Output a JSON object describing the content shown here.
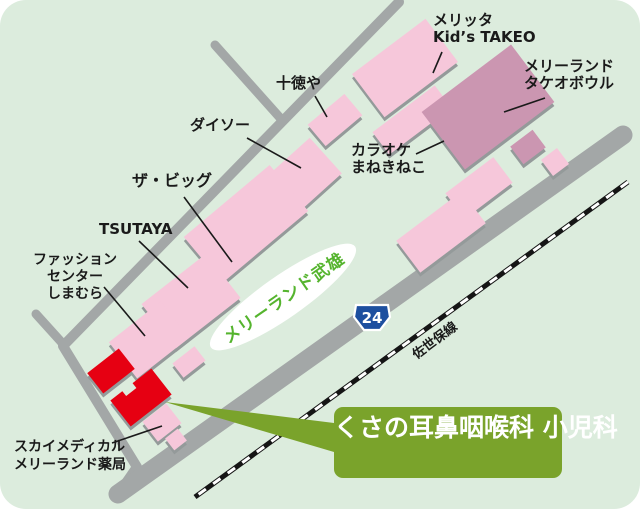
{
  "map_title": "くさの耳鼻咽喉科 小児科 案内地図",
  "colors": {
    "map_bg": "#dcecdd",
    "building_pink": "#f6c7da",
    "building_mauve": "#cb96b1",
    "building_red": "#e60012",
    "road_gray": "#a3a7a7",
    "shadow_gray": "#949a9a",
    "callout_green": "#7aa32b",
    "ellipse_text_green": "#55b42e",
    "shield_blue": "#1d4f9f",
    "railway_black": "#151515",
    "label_black": "#1a1a1a"
  },
  "labels": {
    "melitta": {
      "line1": "メリッタ",
      "line2": "Kid’s TAKEO"
    },
    "bowl": {
      "line1": "メリーランド",
      "line2": "タケオボウル"
    },
    "karaoke": {
      "line1": "カラオケ",
      "line2": "まねきねこ"
    },
    "jutokuya": "十徳や",
    "daiso": "ダイソー",
    "big": "ザ・ビッグ",
    "tsutaya": "TSUTAYA",
    "fashion": {
      "line1": "ファッション",
      "line2": "センター",
      "line3": "しまむら"
    },
    "sky": {
      "line1": "スカイメディカル",
      "line2": "メリーランド薬局"
    },
    "area_ellipse": "メリーランド武雄",
    "railway": "佐世保線",
    "route_shield": "24",
    "clinic": {
      "line1": "くさの耳鼻咽喉科",
      "line2": "小児科"
    }
  },
  "buildings": [
    {
      "name": "メリッタ Kid’s TAKEO",
      "color_role": "pink"
    },
    {
      "name": "メリーランドタケオボウル",
      "color_role": "mauve"
    },
    {
      "name": "カラオケまねきねこ",
      "color_role": "pink"
    },
    {
      "name": "十徳や",
      "color_role": "pink"
    },
    {
      "name": "ダイソー",
      "color_role": "pink"
    },
    {
      "name": "ザ・ビッグ",
      "color_role": "pink"
    },
    {
      "name": "TSUTAYA",
      "color_role": "pink"
    },
    {
      "name": "ファッションセンターしまむら",
      "color_role": "pink"
    },
    {
      "name": "くさの耳鼻咽喉科 小児科",
      "color_role": "red"
    },
    {
      "name": "スカイメディカル メリーランド薬局",
      "color_role": "pink"
    }
  ]
}
